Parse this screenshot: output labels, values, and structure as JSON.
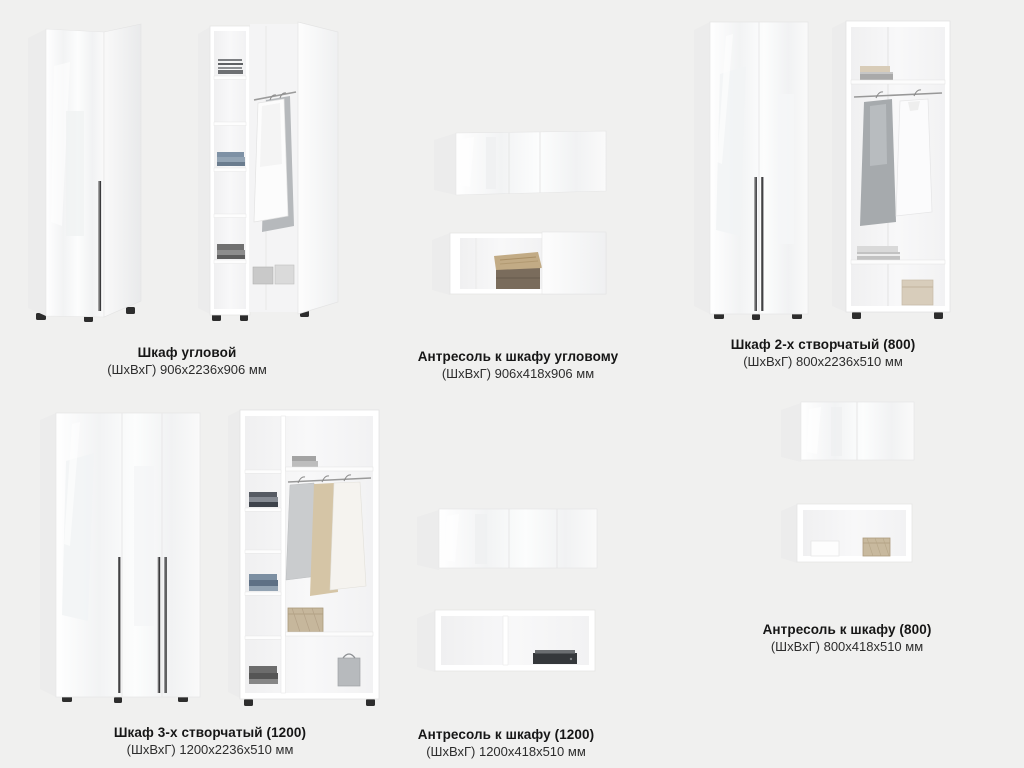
{
  "page": {
    "background": "#f0f0ef",
    "type": "furniture-catalog-sheet"
  },
  "colors": {
    "background": "#f0f0ef",
    "furniture_body": "#ffffff",
    "handle": "#3a3a3c",
    "caption_text": "#161616"
  },
  "products": [
    {
      "id": "corner-wardrobe",
      "title": "Шкаф угловой",
      "dims": "(ШхВхГ) 906х2236х906 мм"
    },
    {
      "id": "corner-mezzanine",
      "title": "Антресоль к шкафу угловому",
      "dims": "(ШхВхГ) 906х418х906 мм"
    },
    {
      "id": "wardrobe-2-door",
      "title": "Шкаф 2-х створчатый (800)",
      "dims": "(ШхВхГ) 800х2236х510 мм"
    },
    {
      "id": "wardrobe-3-door",
      "title": "Шкаф 3-х створчатый (1200)",
      "dims": "(ШхВхГ) 1200х2236х510 мм"
    },
    {
      "id": "mezzanine-1200",
      "title": "Антресоль к шкафу (1200)",
      "dims": "(ШхВхГ) 1200х418х510 мм"
    },
    {
      "id": "mezzanine-800",
      "title": "Антресоль к шкафу (800)",
      "dims": "(ШхВхГ) 800х418х510 мм"
    }
  ]
}
